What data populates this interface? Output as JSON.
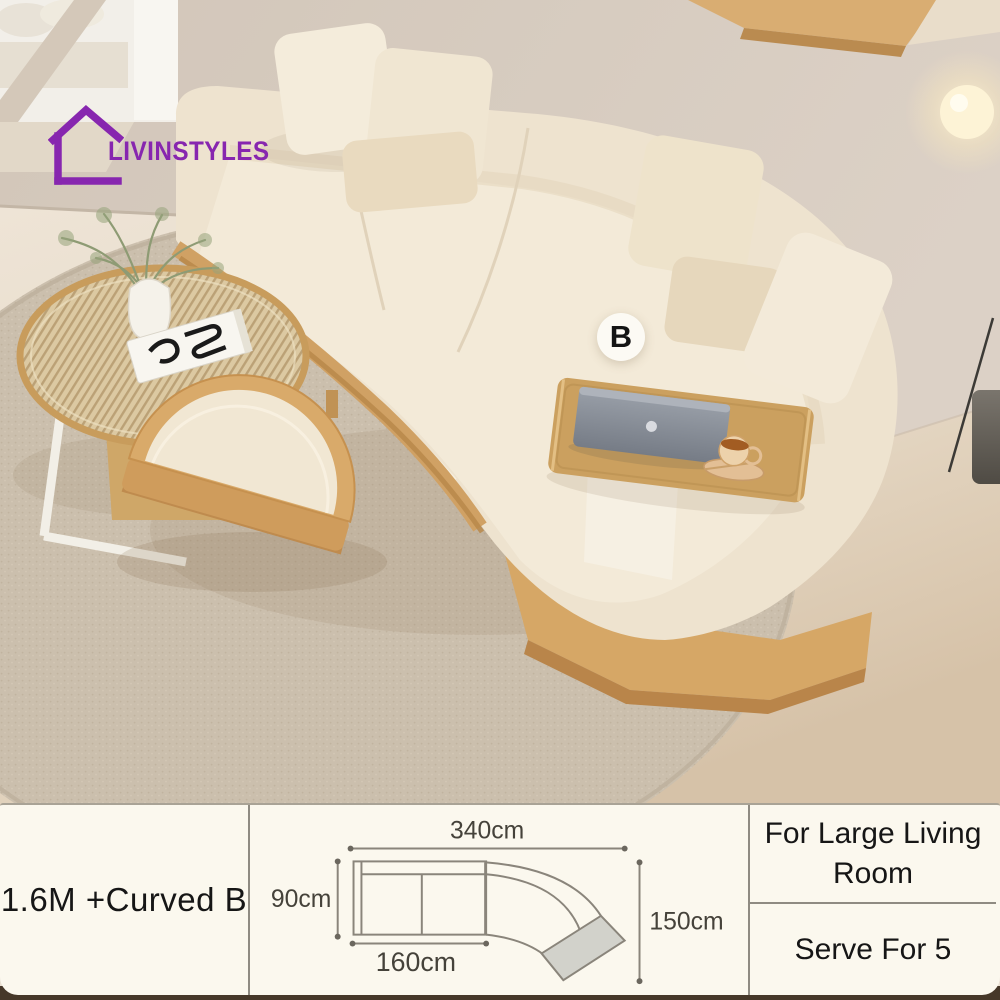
{
  "brand": {
    "name": "LIVINSTYLES",
    "logo_color": "#8726af",
    "icon": "house-outline-icon"
  },
  "photo": {
    "badge_label": "B",
    "scene_objects": [
      "curved-sectional-sofa",
      "throw-pillows",
      "wood-base",
      "round-slatted-coffee-table",
      "plant-in-vase",
      "art-book",
      "semicircle-ottoman",
      "armrest-tray-table",
      "laptop",
      "coffee-cup-with-saucer",
      "floor-lamp",
      "round-rug",
      "wall-shelf"
    ]
  },
  "spec_bar": {
    "variant_label": "1.6M +Curved B",
    "usage_label": "For Large Living Room",
    "capacity_label": "Serve For 5",
    "diagram": {
      "type": "sofa-top-view-dimensions",
      "total_width": "340cm",
      "seat_depth": "90cm",
      "straight_section_length": "160cm",
      "curved_section_length": "150cm"
    }
  },
  "colors": {
    "bar_background": "#fbf8ee",
    "bar_divider": "#8f8b82",
    "text": "#161616",
    "diagram_line": "#8a857b",
    "diagram_fill_gray": "#d2d2cb",
    "wood": "#d2a266",
    "sofa_fabric": "#efe5d2",
    "wall": "#d5cabd",
    "floor": "#e9dfd2",
    "rug": "#cabead",
    "accent": "#8726af"
  }
}
